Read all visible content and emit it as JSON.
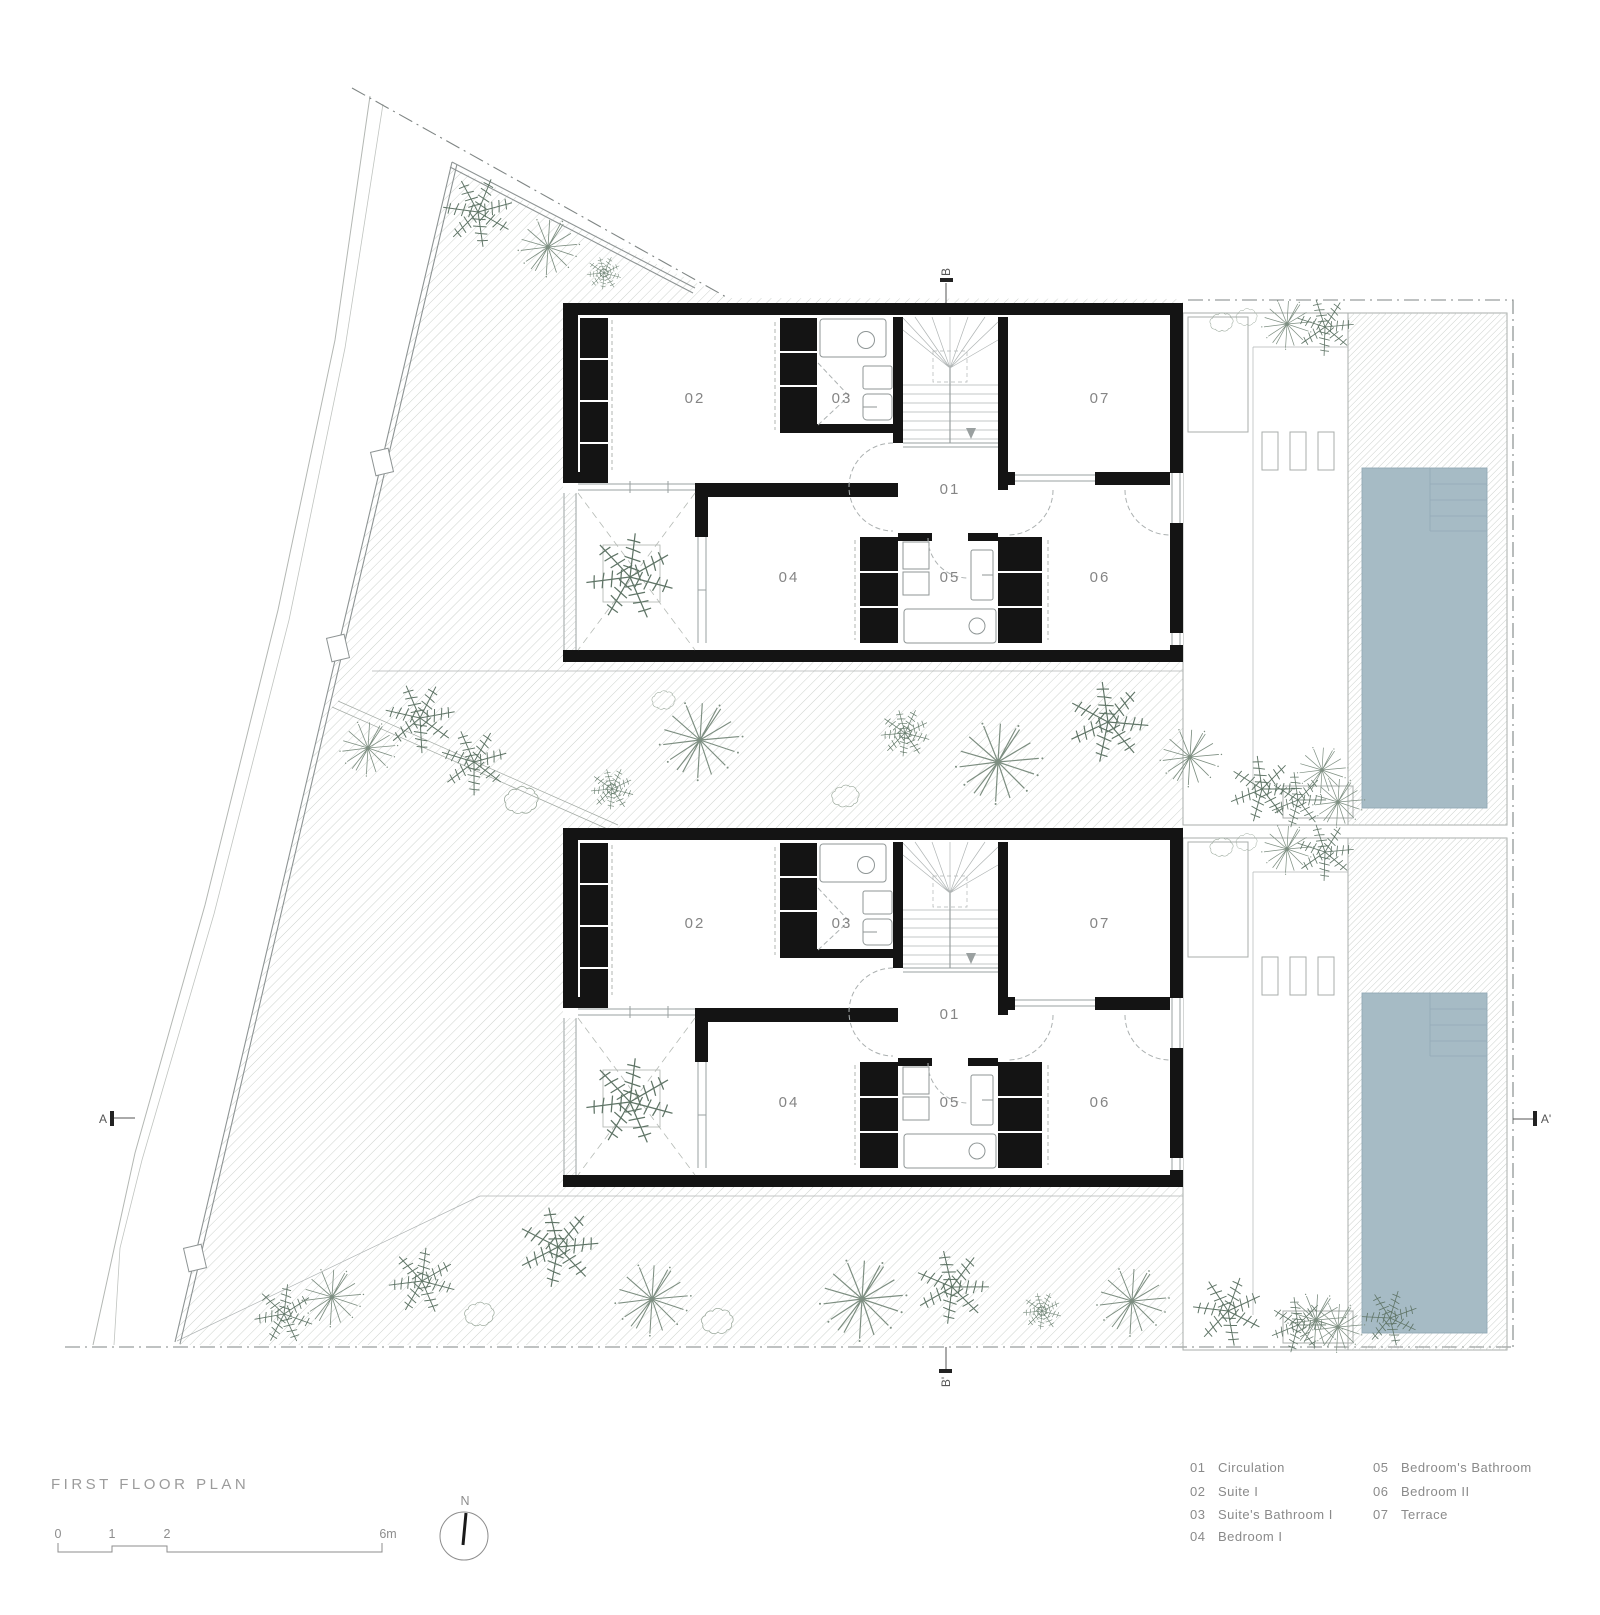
{
  "sheet": {
    "title": "FIRST FLOOR PLAN",
    "scale_bar": {
      "tick_labels": [
        "0",
        "1",
        "2",
        "6m"
      ]
    },
    "north_label": "N"
  },
  "plan": {
    "rooms": {
      "r01": "01",
      "r02": "02",
      "r03": "03",
      "r04": "04",
      "r05": "05",
      "r06": "06",
      "r07": "07"
    },
    "section_markers": {
      "a": "A",
      "a_prime": "A'",
      "b": "B",
      "b_prime": "B'"
    }
  },
  "legend": {
    "items": [
      {
        "num": "01",
        "label": "Circulation"
      },
      {
        "num": "02",
        "label": "Suite I"
      },
      {
        "num": "03",
        "label": "Suite's Bathroom I"
      },
      {
        "num": "04",
        "label": "Bedroom I"
      },
      {
        "num": "05",
        "label": "Bedroom's Bathroom"
      },
      {
        "num": "06",
        "label": "Bedroom II"
      },
      {
        "num": "07",
        "label": "Terrace"
      }
    ]
  },
  "colors": {
    "pool_fill": "#a6bbc5",
    "pool_line": "#93aab6",
    "wall": "#141414",
    "hatch_line": "#cdd2cd",
    "plant_stroke": "#6d8070",
    "boundary_dash": "#7f8584",
    "text_gray": "#8a8a8a"
  }
}
